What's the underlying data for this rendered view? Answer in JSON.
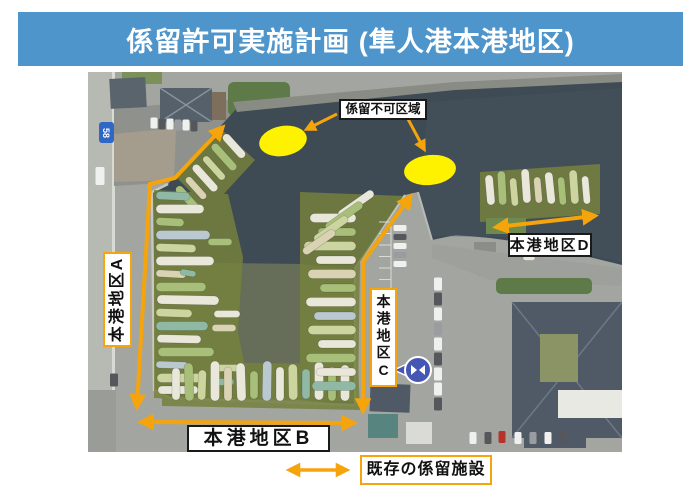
{
  "header": {
    "title": "係留許可実施計画 (隼人港本港地区)"
  },
  "map": {
    "no_mooring_zone_label": "係留不可区域",
    "route_badge": "58",
    "areas": [
      {
        "label": "本港地区A"
      },
      {
        "label": "本港地区B"
      },
      {
        "label": "本港地区C"
      },
      {
        "label": "本港地区D"
      }
    ]
  },
  "legend": {
    "existing_mooring_label": "既存の係留施設"
  },
  "colors": {
    "banner": "#4E95CC",
    "arrow": "#F5A40C",
    "zone": "#FFF200",
    "water": "#3E4B54",
    "mooring": "#76813E"
  }
}
